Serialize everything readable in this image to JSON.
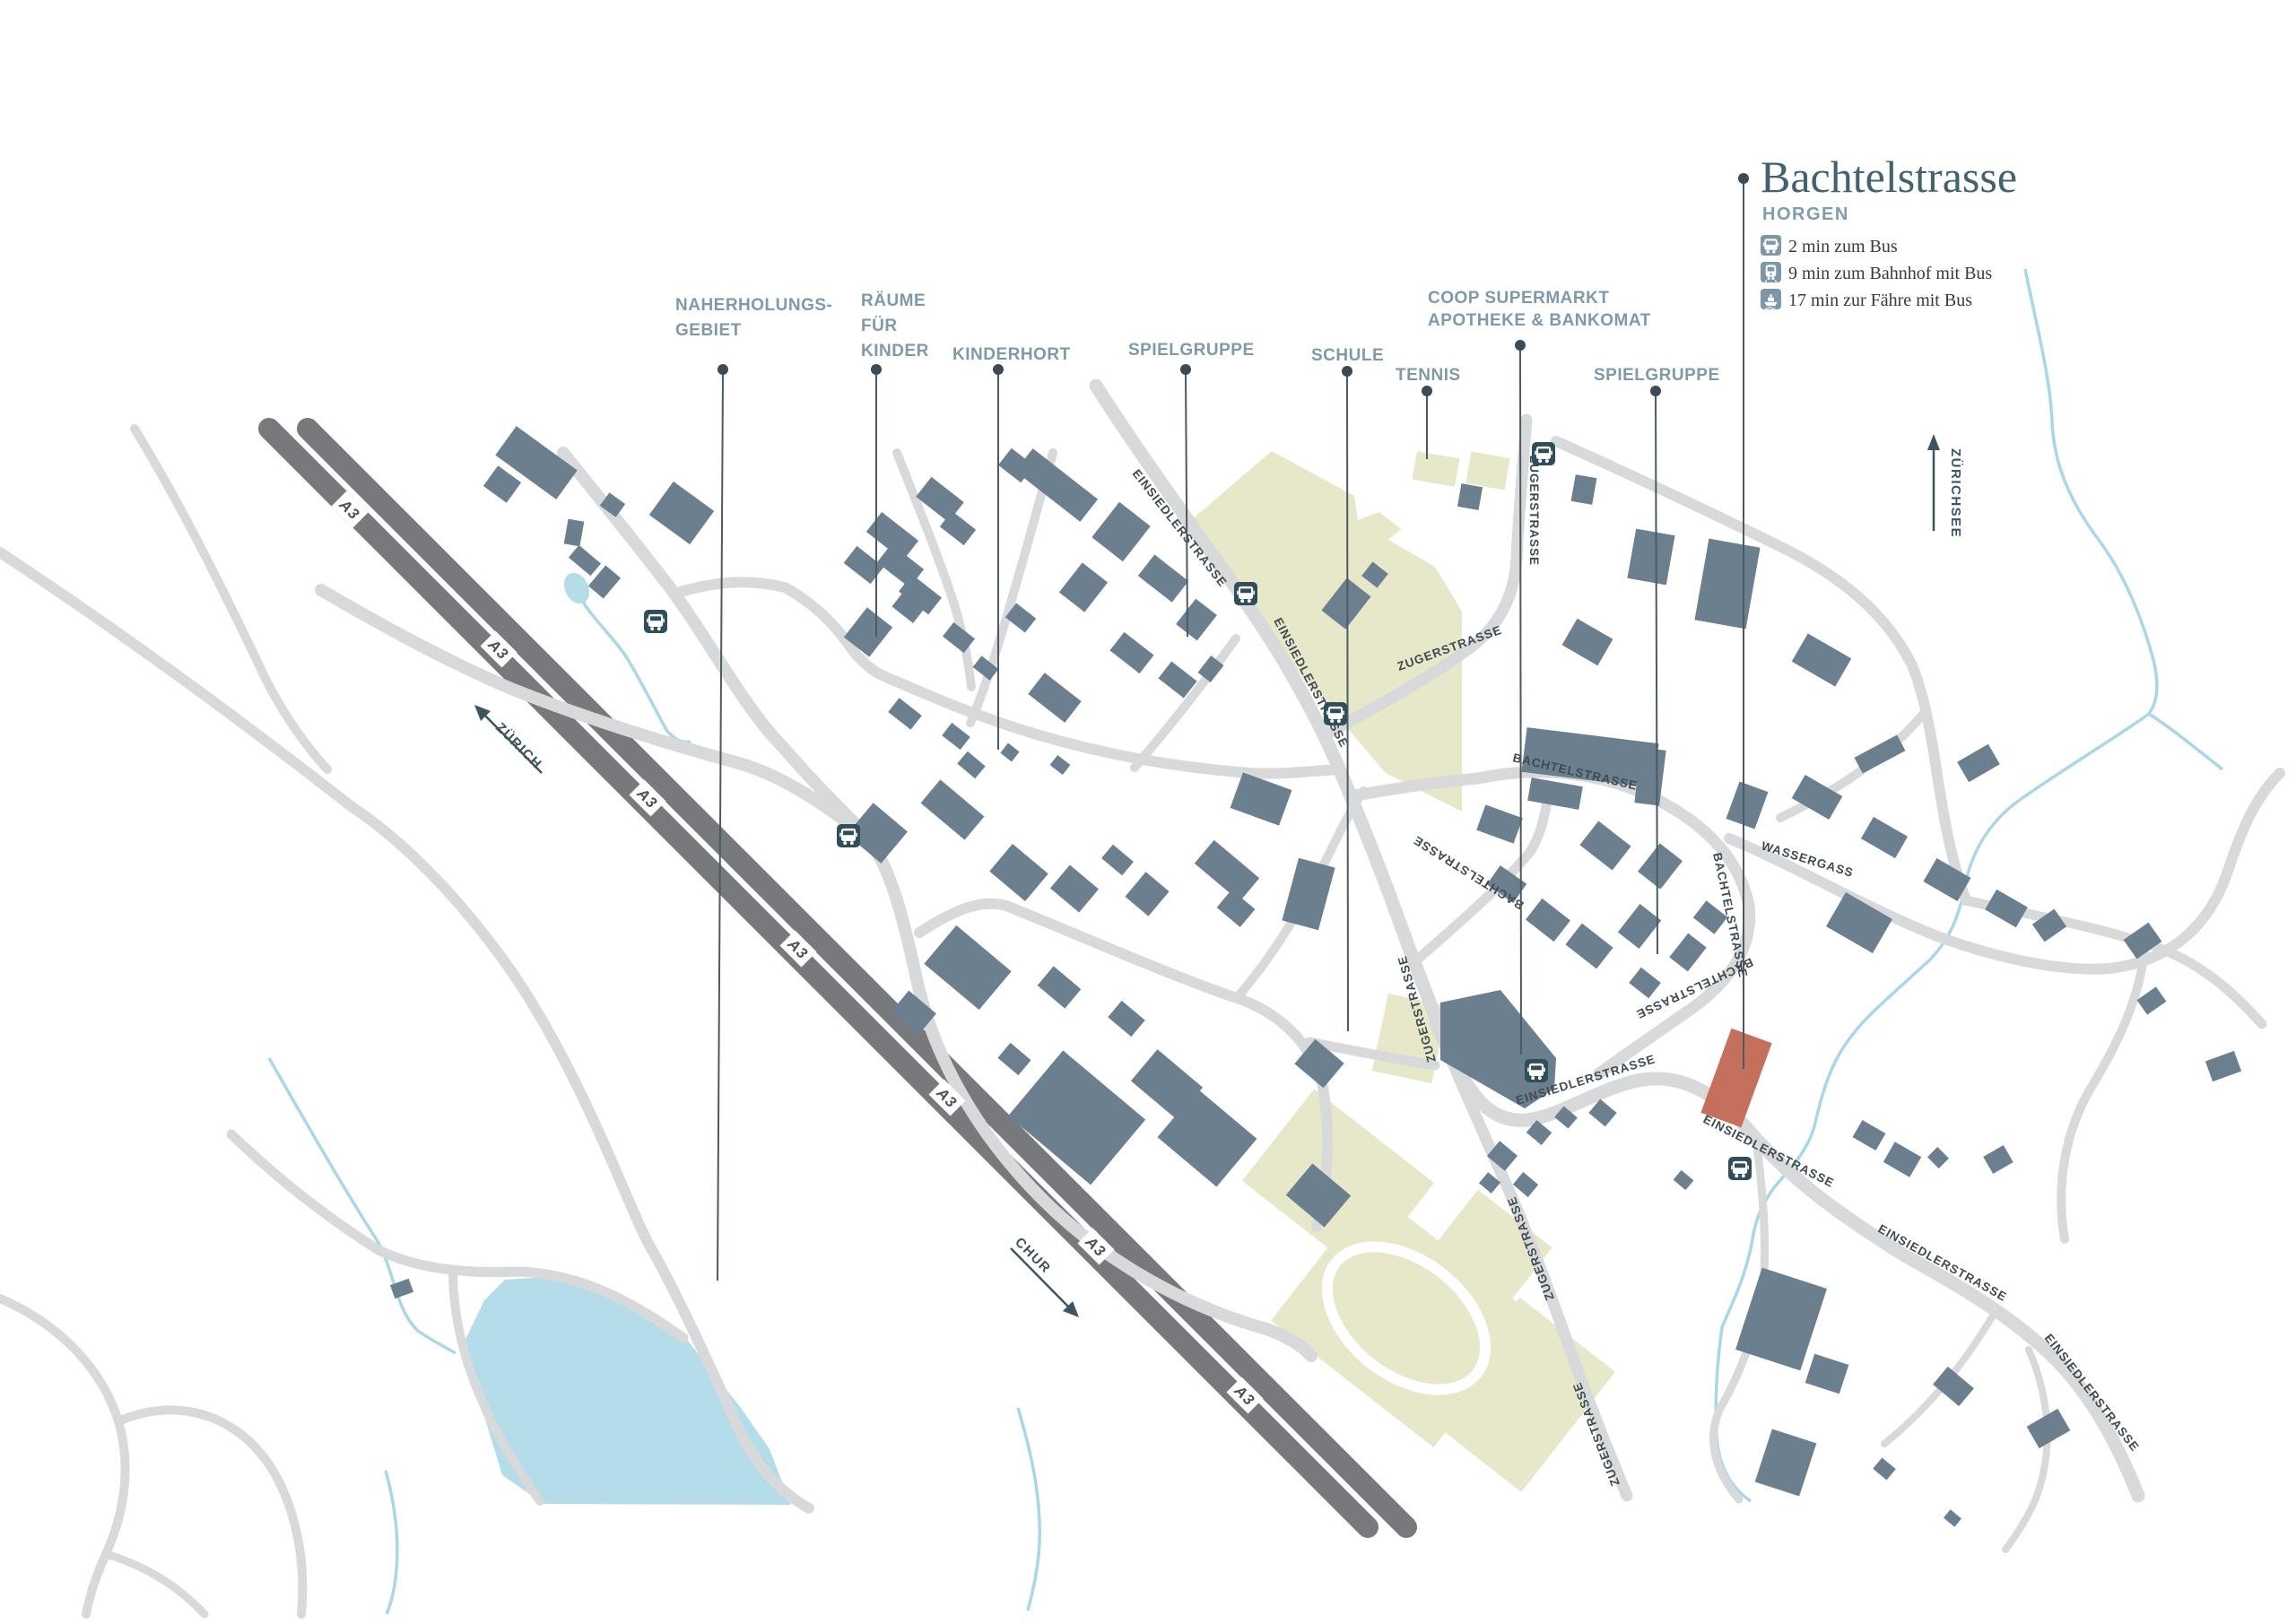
{
  "title": {
    "name": "Bachtelstrasse",
    "municipality": "HORGEN"
  },
  "legend": {
    "items": [
      {
        "icon": "bus-icon",
        "label": "2 min zum Bus"
      },
      {
        "icon": "train-icon",
        "label": "9 min zum Bahnhof mit Bus"
      },
      {
        "icon": "ferry-icon",
        "label": "17 min zur Fähre mit Bus"
      }
    ]
  },
  "poi": {
    "naherholungsgebiet": {
      "line1": "NAHERHOLUNGS-",
      "line2": "GEBIET"
    },
    "raeume_fuer_kinder": {
      "line1": "RÄUME",
      "line2": "FÜR",
      "line3": "KINDER"
    },
    "kinderhort": "KINDERHORT",
    "spielgruppe_west": "SPIELGRUPPE",
    "schule": "SCHULE",
    "tennis": "TENNIS",
    "coop": {
      "line1": "COOP SUPERMARKT",
      "line2": "APOTHEKE & BANKOMAT"
    },
    "spielgruppe_ost": "SPIELGRUPPE"
  },
  "streets": {
    "einsiedlerstrasse": "EINSIEDLERSTRASSE",
    "zugerstrasse": "ZUGERSTRASSE",
    "bachtelstrasse": "BACHTELSTRASSE",
    "wassergass": "WASSERGASS"
  },
  "highway": {
    "label": "A3"
  },
  "directions": {
    "zurich": "ZÜRICH",
    "chur": "CHUR",
    "zuerichsee": "ZÜRICHSEE"
  },
  "icons": {
    "map_stop": "bus-stop-icon"
  },
  "colors": {
    "building": "#6b7f8e",
    "road": "#d8d9da",
    "highway": "#77797c",
    "water": "#a9d7e8",
    "lake": "#b5dde9",
    "green": "#e6e8c9",
    "property_red": "#c4705c",
    "poi_label": "#7e9aaa",
    "title": "#41626f",
    "bus_icon_bg": "#2f4e5a",
    "legend_icon_bg": "#7d97a6",
    "leader_line": "#4b5a63"
  }
}
